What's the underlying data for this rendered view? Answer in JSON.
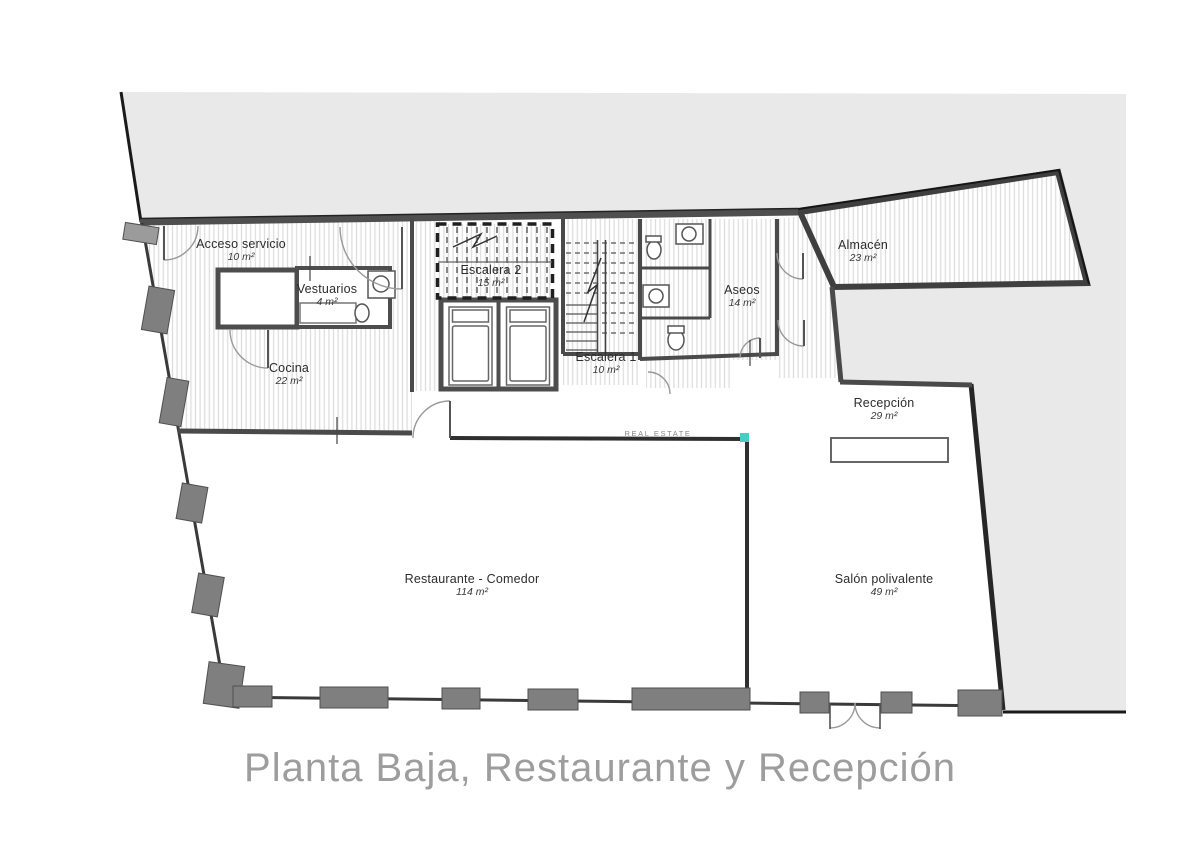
{
  "plan": {
    "title": "Planta Baja, Restaurante y Recepción",
    "watermark": "REAL ESTATE"
  },
  "rooms": [
    {
      "id": "acceso-servicio",
      "name": "Acceso servicio",
      "area": "10 m²"
    },
    {
      "id": "vestuarios",
      "name": "Vestuarios",
      "area": "4 m²"
    },
    {
      "id": "escalera-2",
      "name": "Escalera 2",
      "area": "15 m²"
    },
    {
      "id": "cocina",
      "name": "Cocina",
      "area": "22 m²"
    },
    {
      "id": "escalera-1",
      "name": "Escalera 1",
      "area": "10 m²"
    },
    {
      "id": "aseos",
      "name": "Aseos",
      "area": "14 m²"
    },
    {
      "id": "almacen",
      "name": "Almacén",
      "area": "23 m²"
    },
    {
      "id": "recepcion",
      "name": "Recepción",
      "area": "29 m²"
    },
    {
      "id": "restaurante",
      "name": "Restaurante - Comedor",
      "area": "114 m²"
    },
    {
      "id": "salon",
      "name": "Salón polivalente",
      "area": "49 m²"
    }
  ],
  "colors": {
    "outside_fill": "#e9e9e9",
    "wall": "#4a4a4a",
    "pillar": "#7f7f7f",
    "hatch_line": "#dcdcdc",
    "accent_teal": "#45cfc4",
    "title_color": "#9d9d9d"
  }
}
